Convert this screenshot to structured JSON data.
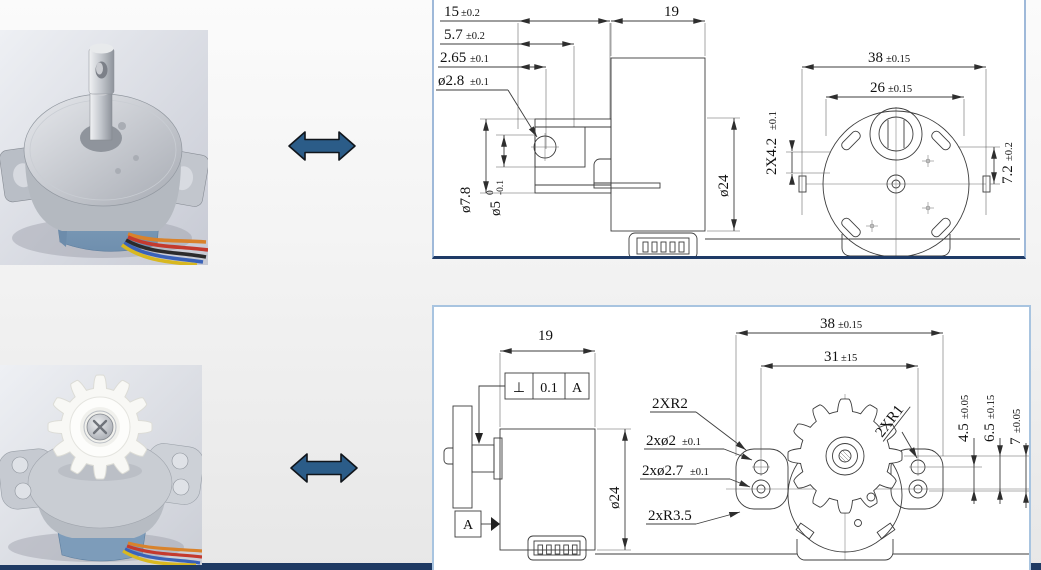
{
  "page": {
    "footer_bar_color": "#1f3a63",
    "panel_border_color": "#9fb9d9",
    "panel_accent_color": "#1e3a66",
    "arrow_color": "#2b5c88"
  },
  "arrows": {
    "top_icon": "double-horizontal-arrow",
    "bottom_icon": "double-horizontal-arrow"
  },
  "top_drawing": {
    "dims": {
      "d15": {
        "v": "15",
        "t": "±0.2"
      },
      "d57": {
        "v": "5.7",
        "t": "±0.2"
      },
      "d265": {
        "v": "2.65",
        "t": "±0.1"
      },
      "d28": {
        "v": "ø2.8",
        "t": "±0.1"
      },
      "d19": {
        "v": "19"
      },
      "d78": {
        "v": "ø7.8"
      },
      "d5": {
        "v": "ø5",
        "upper": "0",
        "lower": "-0.1"
      },
      "d24": {
        "v": "ø24"
      },
      "d42": {
        "v": "2X4.2",
        "t": "±0.1"
      },
      "d38": {
        "v": "38",
        "t": "±0.15"
      },
      "d26": {
        "v": "26",
        "t": "±0.15"
      },
      "d72": {
        "v": "7.2",
        "t": "±0.2"
      }
    }
  },
  "bottom_drawing": {
    "dims": {
      "d19": {
        "v": "19"
      },
      "fcf": {
        "sym": "⊥",
        "val": "0.1",
        "datum": "A"
      },
      "datum": {
        "v": "A"
      },
      "d24": {
        "v": "ø24"
      },
      "r2": {
        "v": "2XR2"
      },
      "h2": {
        "v": "2xø2",
        "t": "±0.1"
      },
      "h27": {
        "v": "2xø2.7",
        "t": "±0.1"
      },
      "r35": {
        "v": "2xR3.5"
      },
      "r1": {
        "v": "2XR1"
      },
      "d38": {
        "v": "38",
        "t": "±0.15"
      },
      "d31": {
        "v": "31",
        "t": "±15"
      },
      "d45": {
        "v": "4.5",
        "t": "±0.05"
      },
      "d65": {
        "v": "6.5",
        "t": "±0.15"
      },
      "d7": {
        "v": "7",
        "t": "±0.05"
      }
    }
  }
}
